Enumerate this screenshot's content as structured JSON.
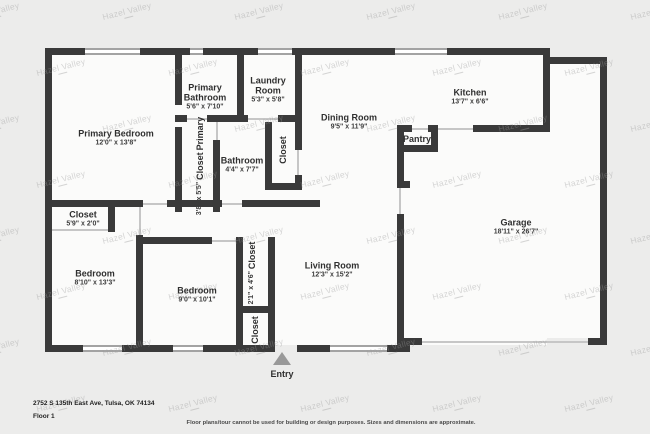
{
  "watermark": {
    "text": "Hazel Valley"
  },
  "rooms": [
    {
      "id": "primary-bedroom",
      "lines": [
        "Primary Bedroom"
      ],
      "dims": "12'0\" x 13'8\""
    },
    {
      "id": "primary-bathroom",
      "lines": [
        "Primary",
        "Bathroom"
      ],
      "dims": "5'6\" x 7'10\""
    },
    {
      "id": "laundry-room",
      "lines": [
        "Laundry",
        "Room"
      ],
      "dims": "5'3\" x 5'8\""
    },
    {
      "id": "dining-room",
      "lines": [
        "Dining Room"
      ],
      "dims": "9'5\" x 11'9\""
    },
    {
      "id": "kitchen",
      "lines": [
        "Kitchen"
      ],
      "dims": "13'7\" x 6'6\""
    },
    {
      "id": "pantry",
      "lines": [
        "Pantry"
      ],
      "dims": ""
    },
    {
      "id": "garage",
      "lines": [
        "Garage"
      ],
      "dims": "18'11\" x 26'7\""
    },
    {
      "id": "bathroom",
      "lines": [
        "Bathroom"
      ],
      "dims": "4'4\" x 7'7\""
    },
    {
      "id": "closet-bathroom",
      "lines": [
        "Closet"
      ],
      "dims": ""
    },
    {
      "id": "primary-closet",
      "lines": [
        "Primary",
        "Closet"
      ],
      "dims": "3'8\" x 5'5\""
    },
    {
      "id": "closet-hall",
      "lines": [
        "Closet"
      ],
      "dims": "5'9\" x 2'0\""
    },
    {
      "id": "bedroom-left",
      "lines": [
        "Bedroom"
      ],
      "dims": "8'10\" x 13'3\""
    },
    {
      "id": "bedroom-middle",
      "lines": [
        "Bedroom"
      ],
      "dims": "9'0\" x 10'1\""
    },
    {
      "id": "closet-entry-upper",
      "lines": [
        "Closet"
      ],
      "dims": "2'1\" x 4'6\""
    },
    {
      "id": "closet-entry-lower",
      "lines": [
        "Closet"
      ],
      "dims": ""
    },
    {
      "id": "living-room",
      "lines": [
        "Living Room"
      ],
      "dims": "12'3\" x 15'2\""
    }
  ],
  "entry": {
    "label": "Entry"
  },
  "footer": {
    "address": "2752 S 135th East Ave, Tulsa, OK 74134",
    "floor_label": "Floor 1",
    "disclaimer": "Floor plans/tour cannot be used for building or design purposes. Sizes and dimensions are approximate."
  },
  "colors": {
    "wall": "#3a3a3a",
    "floor": "#fbfbfa",
    "background": "#ececeb",
    "watermark": "#9a9a9a",
    "entry_arrow": "#999999"
  }
}
